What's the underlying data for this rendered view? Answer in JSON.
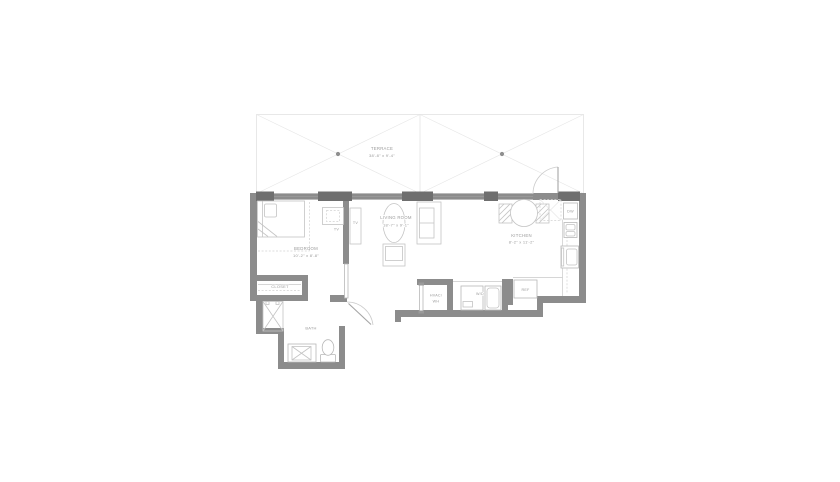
{
  "colors": {
    "wall": "#8c8c8c",
    "window_pier": "#6f6f6f",
    "furniture_line": "#c4c4c4",
    "fixture_line": "#b8b8b8",
    "label_text": "#9a9a9a",
    "background": "#ffffff"
  },
  "rooms": {
    "terrace": {
      "label": "TERRACE",
      "dimensions": "38'-8\" x 9'-4\""
    },
    "living_room": {
      "label": "LIVING ROOM",
      "dimensions": "18'-7\" x 9'-1\""
    },
    "bedroom": {
      "label": "BEDROOM",
      "dimensions": "10'-2\" x 8'-8\""
    },
    "kitchen": {
      "label": "KITCHEN",
      "dimensions": "8'-2\" x 11'-2\""
    },
    "closet": {
      "label": "CLOSET"
    },
    "bath": {
      "label": "BATH"
    }
  },
  "fixtures": {
    "hvac_line1": "HVAC/",
    "hvac_line2": "WH",
    "washer_dryer": "W/D",
    "refrigerator": "REF",
    "dishwasher": "DW",
    "tv_bedroom": "TV",
    "tv_living": "TV"
  }
}
